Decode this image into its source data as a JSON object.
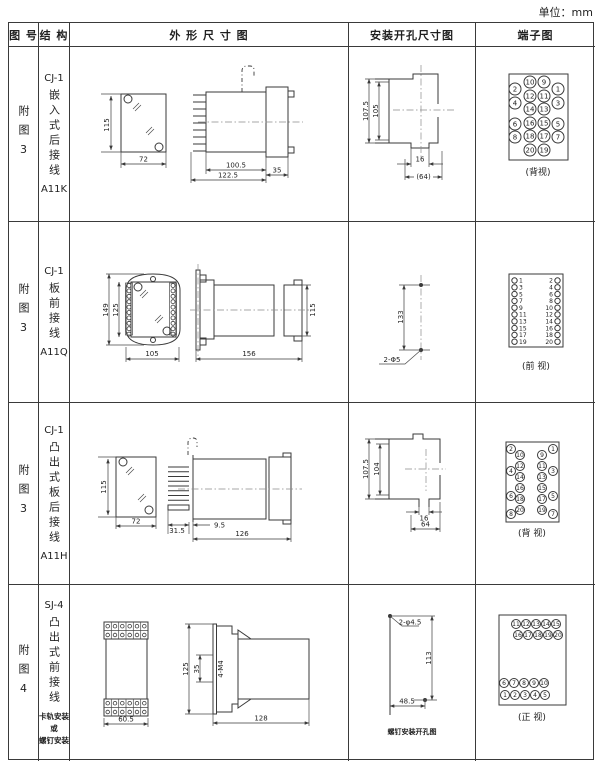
{
  "unit_label": "单位：mm",
  "headers": {
    "fig": "图 号",
    "structure": "结 构",
    "outline": "外 形 尺 寸 图",
    "install": "安装开孔尺寸图",
    "terminal": "端子图"
  },
  "rows": [
    {
      "fig_no": "附图3",
      "model": "CJ-1",
      "type_vertical": "嵌入式后接线",
      "code": "A11K",
      "outline": {
        "front_h": "115",
        "front_w": "72",
        "d1": "100.5",
        "d2": "122.5",
        "d3": "35"
      },
      "install": {
        "v1": "107.5",
        "v2": "105",
        "slot": "16",
        "span": "(64)"
      },
      "terminal": {
        "caption": "(背视)",
        "mid_left": [
          10,
          12,
          14,
          16,
          18,
          20
        ],
        "mid_right": [
          9,
          11,
          13,
          15,
          17,
          19
        ],
        "outer_left": [
          2,
          4,
          6,
          8
        ],
        "outer_right": [
          1,
          3,
          5,
          7
        ]
      }
    },
    {
      "fig_no": "附图3",
      "model": "CJ-1",
      "type_vertical": "板前接线",
      "code": "A11Q",
      "outline": {
        "h1": "149",
        "h2": "125",
        "w": "105",
        "depth": "156",
        "side_h": "115"
      },
      "install": {
        "v": "133",
        "holes": "2-Φ5"
      },
      "terminal": {
        "caption": "(前 视)",
        "left": [
          1,
          3,
          5,
          7,
          9,
          11,
          13,
          15,
          17,
          19
        ],
        "right": [
          2,
          4,
          6,
          8,
          10,
          12,
          14,
          16,
          18,
          20
        ]
      }
    },
    {
      "fig_no": "附图3",
      "model": "CJ-1",
      "type_vertical": "凸出式板后接线",
      "code": "A11H",
      "outline": {
        "front_h": "115",
        "front_w": "72",
        "pins": "31.5",
        "gap": "9.5",
        "depth": "126"
      },
      "install": {
        "v1": "107.5",
        "v2": "104",
        "slot": "16",
        "span": "64"
      },
      "terminal": {
        "caption": "(背 视)",
        "mid_left": [
          10,
          12,
          14,
          16,
          18,
          20
        ],
        "mid_right": [
          9,
          11,
          13,
          15,
          17,
          19
        ],
        "outer_left": [
          2,
          4,
          6,
          8
        ],
        "outer_right": [
          1,
          3,
          5,
          7
        ]
      }
    },
    {
      "fig_no": "附图4",
      "model": "SJ-4",
      "type_vertical": "凸出式前接线",
      "mount_note": [
        "卡轨安装",
        "或",
        "螺钉安装"
      ],
      "outline": {
        "w": "60.5",
        "h": "125",
        "inner": "35",
        "screw": "4-M4",
        "depth": "128"
      },
      "install": {
        "holes": "2-φ4.5",
        "v": "113",
        "h": "48.5",
        "caption": "螺钉安装开孔图"
      },
      "terminal": {
        "caption": "(正 视)",
        "grid": [
          [
            11,
            12,
            13,
            14,
            15
          ],
          [
            16,
            17,
            18,
            19,
            20
          ],
          [
            6,
            7,
            8,
            9,
            10
          ],
          [
            1,
            2,
            3,
            4,
            5
          ]
        ]
      }
    }
  ]
}
